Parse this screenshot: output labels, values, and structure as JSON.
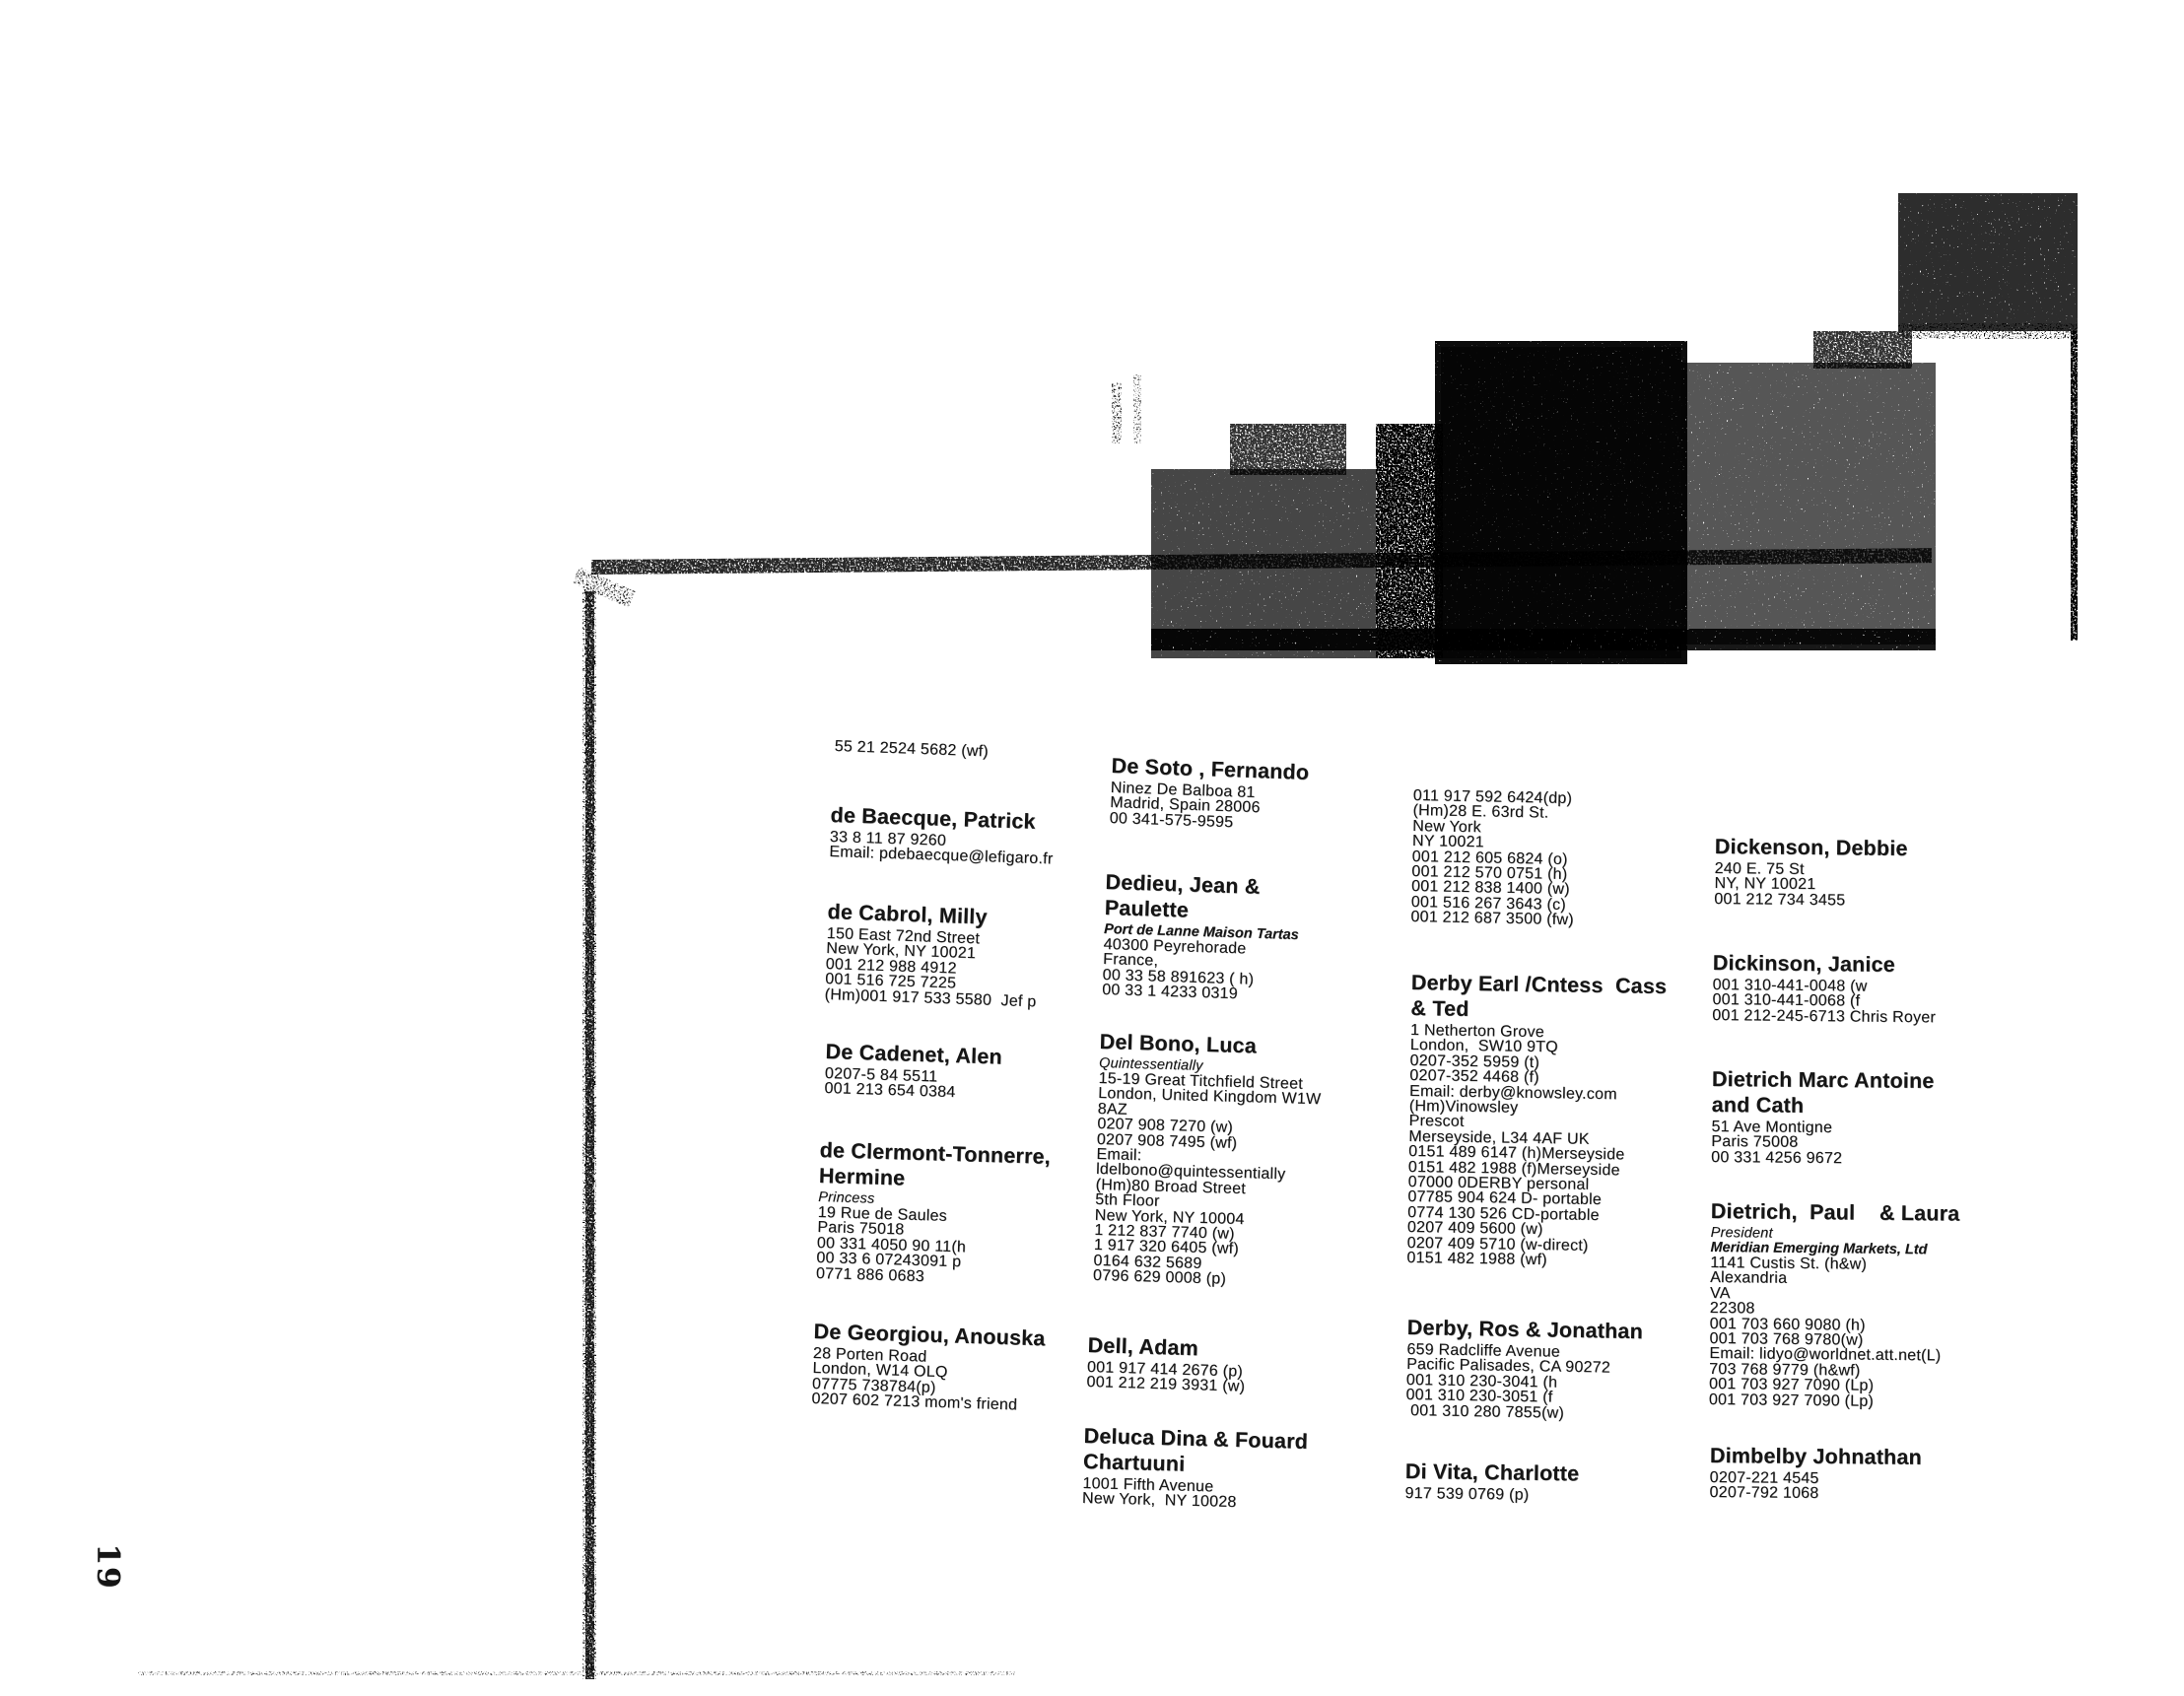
{
  "page": {
    "number": "19"
  },
  "colors": {
    "ink": "#151515",
    "paper": "#ffffff"
  },
  "columns": [
    {
      "entries": [
        {
          "lines": [
            {
              "t": "55 21 2524 5682 (wf)",
              "s": "line"
            }
          ]
        },
        {
          "lines": [
            {
              "t": "de Baecque, Patrick",
              "s": "name"
            },
            {
              "t": "33 8 11 87 9260",
              "s": "line"
            },
            {
              "t": "Email: pdebaecque@lefigaro.fr",
              "s": "line"
            }
          ]
        },
        {
          "lines": [
            {
              "t": "de Cabrol, Milly",
              "s": "name"
            },
            {
              "t": "150 East 72nd Street",
              "s": "line"
            },
            {
              "t": "New York, NY 10021",
              "s": "line"
            },
            {
              "t": "001 212 988 4912",
              "s": "line"
            },
            {
              "t": "001 516 725 7225",
              "s": "line"
            },
            {
              "t": "(Hm)001 917 533 5580  Jef p",
              "s": "line"
            }
          ]
        },
        {
          "lines": [
            {
              "t": "De Cadenet, Alen",
              "s": "name"
            },
            {
              "t": "0207-5 84 5511",
              "s": "line"
            },
            {
              "t": "001 213 654 0384",
              "s": "line"
            }
          ]
        },
        {
          "lines": [
            {
              "t": "de Clermont-Tonnerre,",
              "s": "name"
            },
            {
              "t": "Hermine",
              "s": "name"
            },
            {
              "t": "Princess",
              "s": "italic"
            },
            {
              "t": "19 Rue de Saules",
              "s": "line"
            },
            {
              "t": "Paris 75018",
              "s": "line"
            },
            {
              "t": "00 331 4050 90 11(h",
              "s": "line"
            },
            {
              "t": "00 33 6 07243091 p",
              "s": "line"
            },
            {
              "t": "0771 886 0683",
              "s": "line"
            }
          ]
        },
        {
          "lines": [
            {
              "t": "De Georgiou, Anouska",
              "s": "name"
            },
            {
              "t": "28 Porten Road",
              "s": "line"
            },
            {
              "t": "London, W14 OLQ",
              "s": "line"
            },
            {
              "t": "07775 738784(p)",
              "s": "line"
            },
            {
              "t": "0207 602 7213 mom's friend",
              "s": "line"
            }
          ]
        }
      ]
    },
    {
      "entries": [
        {
          "lines": [
            {
              "t": "De Soto , Fernando",
              "s": "name"
            },
            {
              "t": "Ninez De Balboa 81",
              "s": "line"
            },
            {
              "t": "Madrid, Spain 28006",
              "s": "line"
            },
            {
              "t": "00 341-575-9595",
              "s": "line"
            }
          ]
        },
        {
          "lines": [
            {
              "t": "Dedieu, Jean &",
              "s": "name"
            },
            {
              "t": "Paulette",
              "s": "name"
            },
            {
              "t": "Port de Lanne Maison Tartas",
              "s": "bolditalic"
            },
            {
              "t": "40300 Peyrehorade",
              "s": "line"
            },
            {
              "t": "France,",
              "s": "line"
            },
            {
              "t": "00 33 58 891623 ( h)",
              "s": "line"
            },
            {
              "t": "00 33 1 4233 0319",
              "s": "line"
            }
          ]
        },
        {
          "lines": [
            {
              "t": "Del Bono, Luca",
              "s": "name"
            },
            {
              "t": "Quintessentially",
              "s": "italic"
            },
            {
              "t": "15-19 Great Titchfield Street",
              "s": "line"
            },
            {
              "t": "London, United Kingdom W1W",
              "s": "line"
            },
            {
              "t": "8AZ",
              "s": "line"
            },
            {
              "t": "0207 908 7270 (w)",
              "s": "line"
            },
            {
              "t": "0207 908 7495 (wf)",
              "s": "line"
            },
            {
              "t": "Email:",
              "s": "line"
            },
            {
              "t": "ldelbono@quintessentially",
              "s": "line"
            },
            {
              "t": "(Hm)80 Broad Street",
              "s": "line"
            },
            {
              "t": "5th Floor",
              "s": "line"
            },
            {
              "t": "New York, NY 10004",
              "s": "line"
            },
            {
              "t": "1 212 837 7740 (w)",
              "s": "line"
            },
            {
              "t": "1 917 320 6405 (wf)",
              "s": "line"
            },
            {
              "t": "0164 632 5689",
              "s": "line"
            },
            {
              "t": "0796 629 0008 (p)",
              "s": "line"
            }
          ]
        },
        {
          "lines": [
            {
              "t": "Dell, Adam",
              "s": "name"
            },
            {
              "t": "001 917 414 2676 (p)",
              "s": "line"
            },
            {
              "t": "001 212 219 3931 (w)",
              "s": "line"
            }
          ]
        },
        {
          "lines": [
            {
              "t": "Deluca Dina & Fouard",
              "s": "name"
            },
            {
              "t": "Chartuuni",
              "s": "name"
            },
            {
              "t": "1001 Fifth Avenue",
              "s": "line"
            },
            {
              "t": "New York,  NY 10028",
              "s": "line"
            }
          ]
        }
      ]
    },
    {
      "entries": [
        {
          "lines": [
            {
              "t": "011 917 592 6424(dp)",
              "s": "line"
            },
            {
              "t": "(Hm)28 E. 63rd St.",
              "s": "line"
            },
            {
              "t": "New York",
              "s": "line"
            },
            {
              "t": "NY 10021",
              "s": "line"
            },
            {
              "t": "001 212 605 6824 (o)",
              "s": "line"
            },
            {
              "t": "001 212 570 0751 (h)",
              "s": "line"
            },
            {
              "t": "001 212 838 1400 (w)",
              "s": "line"
            },
            {
              "t": "001 516 267 3643 (c)",
              "s": "line"
            },
            {
              "t": "001 212 687 3500 (fw)",
              "s": "line"
            }
          ]
        },
        {
          "lines": [
            {
              "t": "Derby Earl /Cntess  Cass",
              "s": "name"
            },
            {
              "t": "& Ted",
              "s": "name"
            },
            {
              "t": "1 Netherton Grove",
              "s": "line"
            },
            {
              "t": "London,  SW10 9TQ",
              "s": "line"
            },
            {
              "t": "0207-352 5959 (t)",
              "s": "line"
            },
            {
              "t": "0207-352 4468 (f)",
              "s": "line"
            },
            {
              "t": "Email: derby@knowsley.com",
              "s": "line"
            },
            {
              "t": "(Hm)Vinowsley",
              "s": "line"
            },
            {
              "t": "Prescot",
              "s": "line"
            },
            {
              "t": "Merseyside, L34 4AF UK",
              "s": "line"
            },
            {
              "t": "0151 489 6147 (h)Merseyside",
              "s": "line"
            },
            {
              "t": "0151 482 1988 (f)Merseyside",
              "s": "line"
            },
            {
              "t": "07000 0DERBY personal",
              "s": "line"
            },
            {
              "t": "07785 904 624 D- portable",
              "s": "line"
            },
            {
              "t": "0774 130 526 CD-portable",
              "s": "line"
            },
            {
              "t": "0207 409 5600 (w)",
              "s": "line"
            },
            {
              "t": "0207 409 5710 (w-direct)",
              "s": "line"
            },
            {
              "t": "0151 482 1988 (wf)",
              "s": "line"
            }
          ]
        },
        {
          "lines": [
            {
              "t": "Derby, Ros & Jonathan",
              "s": "name"
            },
            {
              "t": "659 Radcliffe Avenue",
              "s": "line"
            },
            {
              "t": "Pacific Palisades, CA 90272",
              "s": "line"
            },
            {
              "t": "001 310 230-3041 (h",
              "s": "line"
            },
            {
              "t": "001 310 230-3051 (f",
              "s": "line"
            },
            {
              "t": " 001 310 280 7855(w)",
              "s": "line"
            }
          ]
        },
        {
          "lines": [
            {
              "t": "Di Vita, Charlotte",
              "s": "name"
            },
            {
              "t": "917 539 0769 (p)",
              "s": "line"
            }
          ]
        }
      ]
    },
    {
      "entries": [
        {
          "lines": [
            {
              "t": "Dickenson, Debbie",
              "s": "name"
            },
            {
              "t": "240 E. 75 St",
              "s": "line"
            },
            {
              "t": "NY, NY 10021",
              "s": "line"
            },
            {
              "t": "001 212 734 3455",
              "s": "line"
            }
          ]
        },
        {
          "lines": [
            {
              "t": "Dickinson, Janice",
              "s": "name"
            },
            {
              "t": "001 310-441-0048 (w",
              "s": "line"
            },
            {
              "t": "001 310-441-0068 (f",
              "s": "line"
            },
            {
              "t": "001 212-245-6713 Chris Royer",
              "s": "line"
            }
          ]
        },
        {
          "lines": [
            {
              "t": "Dietrich Marc Antoine",
              "s": "name"
            },
            {
              "t": "and Cath",
              "s": "name"
            },
            {
              "t": "51 Ave Montigne",
              "s": "line"
            },
            {
              "t": "Paris 75008",
              "s": "line"
            },
            {
              "t": "00 331 4256 9672",
              "s": "line"
            }
          ]
        },
        {
          "lines": [
            {
              "t": "Dietrich,  Paul    & Laura",
              "s": "name"
            },
            {
              "t": "President",
              "s": "italic"
            },
            {
              "t": "Meridian Emerging Markets, Ltd",
              "s": "bolditalic"
            },
            {
              "t": "1141 Custis St. (h&w)",
              "s": "line"
            },
            {
              "t": "Alexandria",
              "s": "line"
            },
            {
              "t": "VA",
              "s": "line"
            },
            {
              "t": "22308",
              "s": "line"
            },
            {
              "t": "001 703 660 9080 (h)",
              "s": "line"
            },
            {
              "t": "001 703 768 9780(w)",
              "s": "line"
            },
            {
              "t": "Email: lidyo@worldnet.att.net(L)",
              "s": "line"
            },
            {
              "t": "703 768 9779 (h&wf)",
              "s": "line"
            },
            {
              "t": "001 703 927 7090 (Lp)",
              "s": "line"
            },
            {
              "t": "001 703 927 7090 (Lp)",
              "s": "line"
            }
          ]
        },
        {
          "lines": [
            {
              "t": "Dimbelby Johnathan",
              "s": "name"
            },
            {
              "t": "0207-221 4545",
              "s": "line"
            },
            {
              "t": "0207-792 1068",
              "s": "line"
            }
          ]
        }
      ]
    }
  ]
}
